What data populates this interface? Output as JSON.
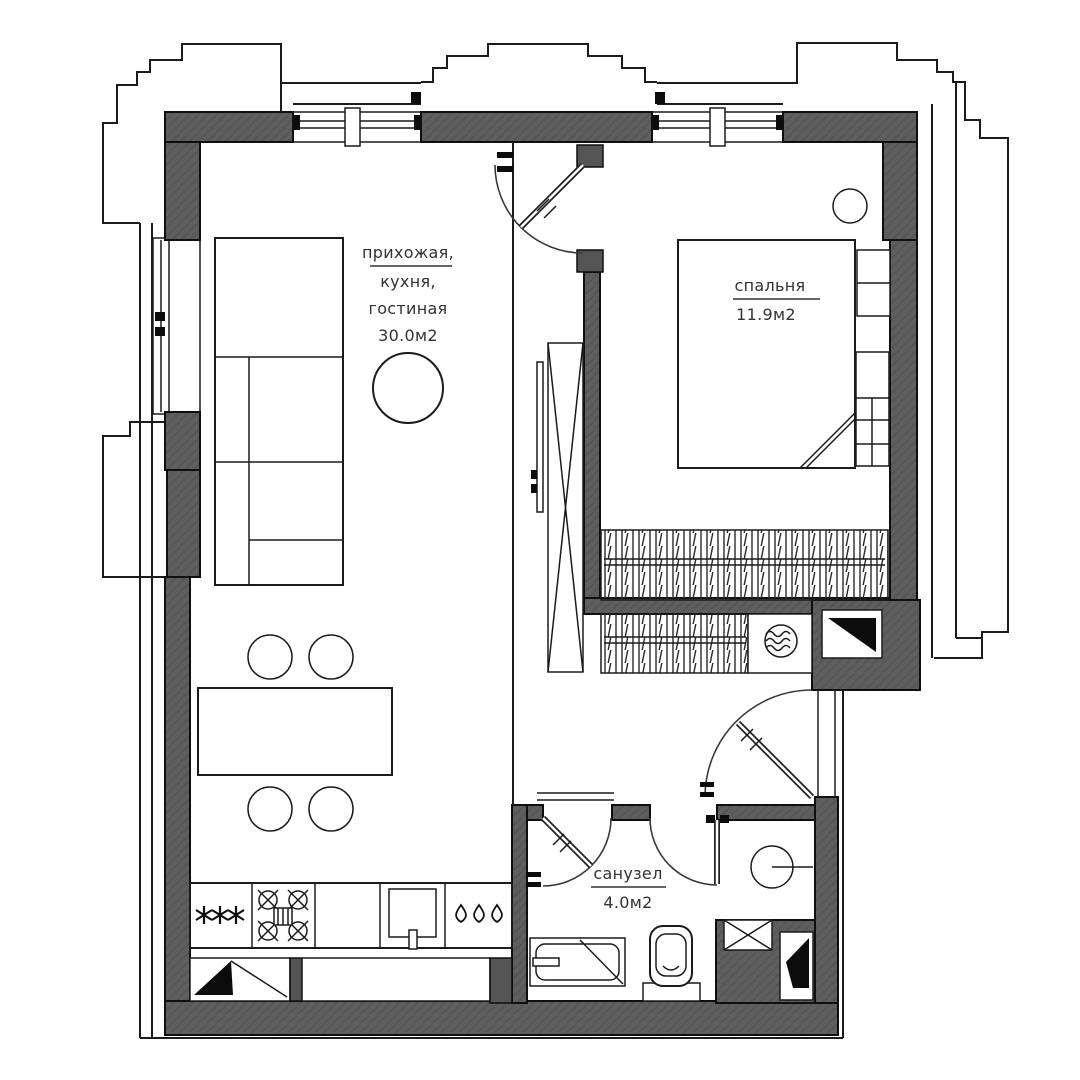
{
  "plan": {
    "type": "apartment-floor-plan",
    "language": "ru",
    "rooms": [
      {
        "id": "living",
        "label_lines": [
          "прихожая,",
          "кухня,",
          "гостиная"
        ],
        "area": "30.0м2"
      },
      {
        "id": "bedroom",
        "label": "спальня",
        "area": "11.9м2"
      },
      {
        "id": "bathroom",
        "label": "санузел",
        "area": "4.0м2"
      }
    ],
    "colors": {
      "wall": "#5e5e5e",
      "line": "#1b1b1b",
      "background": "#ffffff",
      "text": "#323232"
    },
    "fixtures": [
      "sofa",
      "round-table",
      "dining-table",
      "bar-stool",
      "kitchen-counter",
      "fridge-icon",
      "stove-icon",
      "sink-icon",
      "water-drops-icon",
      "tall-wardrobe",
      "closet-hangers",
      "bed",
      "nightstand",
      "ceiling-lamp",
      "fan-icon",
      "vent-shaft-icon",
      "washbasin",
      "toilet",
      "bathtub",
      "entry-door",
      "hall-door",
      "bathroom-door",
      "shower-screen",
      "window"
    ]
  }
}
